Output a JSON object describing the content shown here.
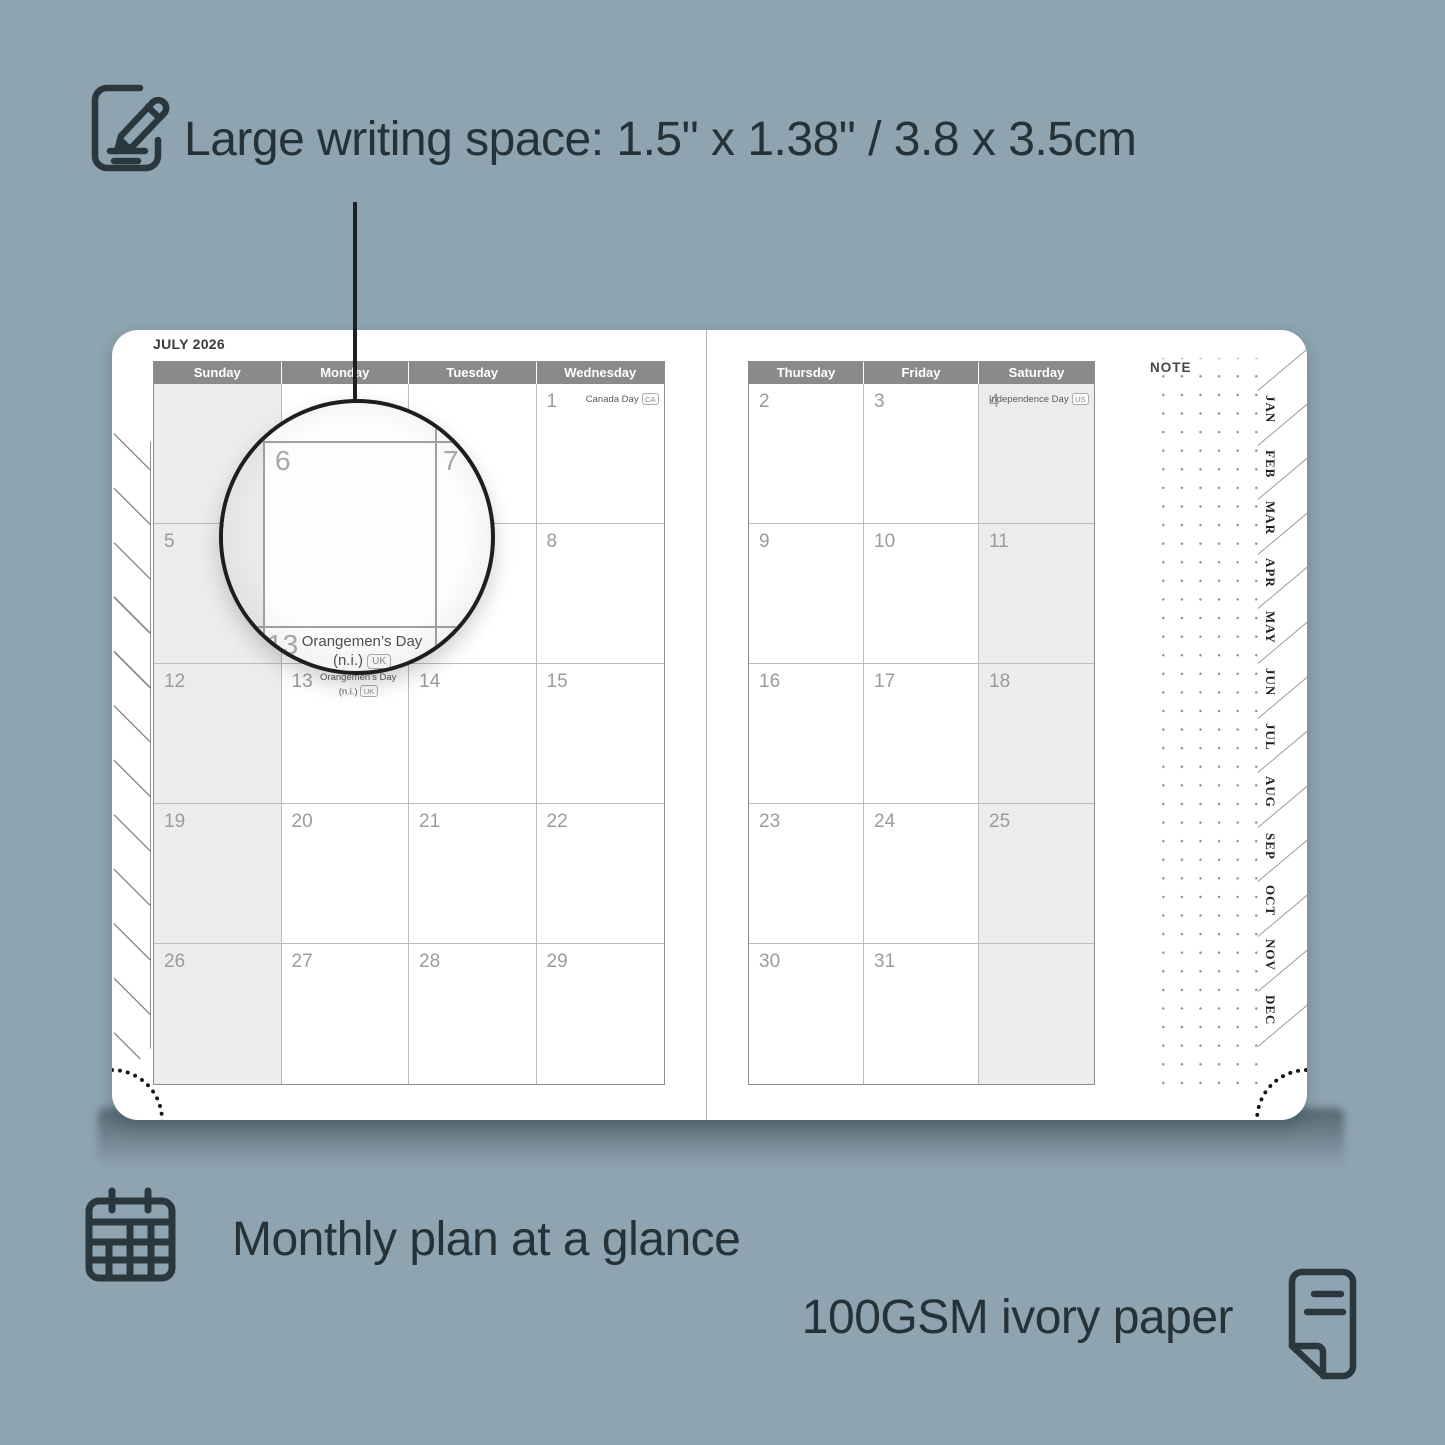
{
  "features": {
    "writing_space": "Large writing space: 1.5\" x 1.38\" / 3.8 x 3.5cm",
    "monthly_plan": "Monthly plan at a glance",
    "paper": "100GSM ivory paper"
  },
  "icons": {
    "top": "notepad-pencil-icon",
    "monthly": "calendar-grid-icon",
    "paper": "paper-sheet-icon"
  },
  "colors": {
    "background": "#8ea4b0",
    "ink": "#253338",
    "header_gray": "#8a8a8a",
    "cell_shade": "#ececec",
    "page_white": "#ffffff"
  },
  "planner": {
    "month_title": "JULY 2026",
    "note_label": "NOTE",
    "left_day_headers": [
      "Sunday",
      "Monday",
      "Tuesday",
      "Wednesday"
    ],
    "right_day_headers": [
      "Thursday",
      "Friday",
      "Saturday"
    ],
    "month_tabs": [
      "JAN",
      "FEB",
      "MAR",
      "APR",
      "MAY",
      "JUN",
      "JUL",
      "AUG",
      "SEP",
      "OCT",
      "NOV",
      "DEC"
    ],
    "left_weeks": [
      [
        {
          "date": ""
        },
        {
          "date": ""
        },
        {
          "date": ""
        },
        {
          "date": "1",
          "holiday": "Canada Day",
          "badge": "CA"
        }
      ],
      [
        {
          "date": "5"
        },
        {
          "date": "6"
        },
        {
          "date": "7"
        },
        {
          "date": "8"
        }
      ],
      [
        {
          "date": "12"
        },
        {
          "date": "13",
          "holiday_line1": "Orangemen’s Day",
          "holiday_line2": "(n.i.)",
          "badge": "UK"
        },
        {
          "date": "14"
        },
        {
          "date": "15"
        }
      ],
      [
        {
          "date": "19"
        },
        {
          "date": "20"
        },
        {
          "date": "21"
        },
        {
          "date": "22"
        }
      ],
      [
        {
          "date": "26"
        },
        {
          "date": "27"
        },
        {
          "date": "28"
        },
        {
          "date": "29"
        }
      ]
    ],
    "right_weeks": [
      [
        {
          "date": "2"
        },
        {
          "date": "3"
        },
        {
          "date": "4",
          "holiday": "Independence Day",
          "badge": "US"
        }
      ],
      [
        {
          "date": "9"
        },
        {
          "date": "10"
        },
        {
          "date": "11"
        }
      ],
      [
        {
          "date": "16"
        },
        {
          "date": "17"
        },
        {
          "date": "18"
        }
      ],
      [
        {
          "date": "23"
        },
        {
          "date": "24"
        },
        {
          "date": "25"
        }
      ],
      [
        {
          "date": "30"
        },
        {
          "date": "31"
        },
        {
          "date": ""
        }
      ]
    ],
    "magnifier": {
      "date_left": "6",
      "date_right": "7",
      "date_bottom": "13",
      "holiday_line1": "Orangemen’s Day",
      "holiday_line2": "(n.i.)",
      "badge": "UK"
    }
  }
}
